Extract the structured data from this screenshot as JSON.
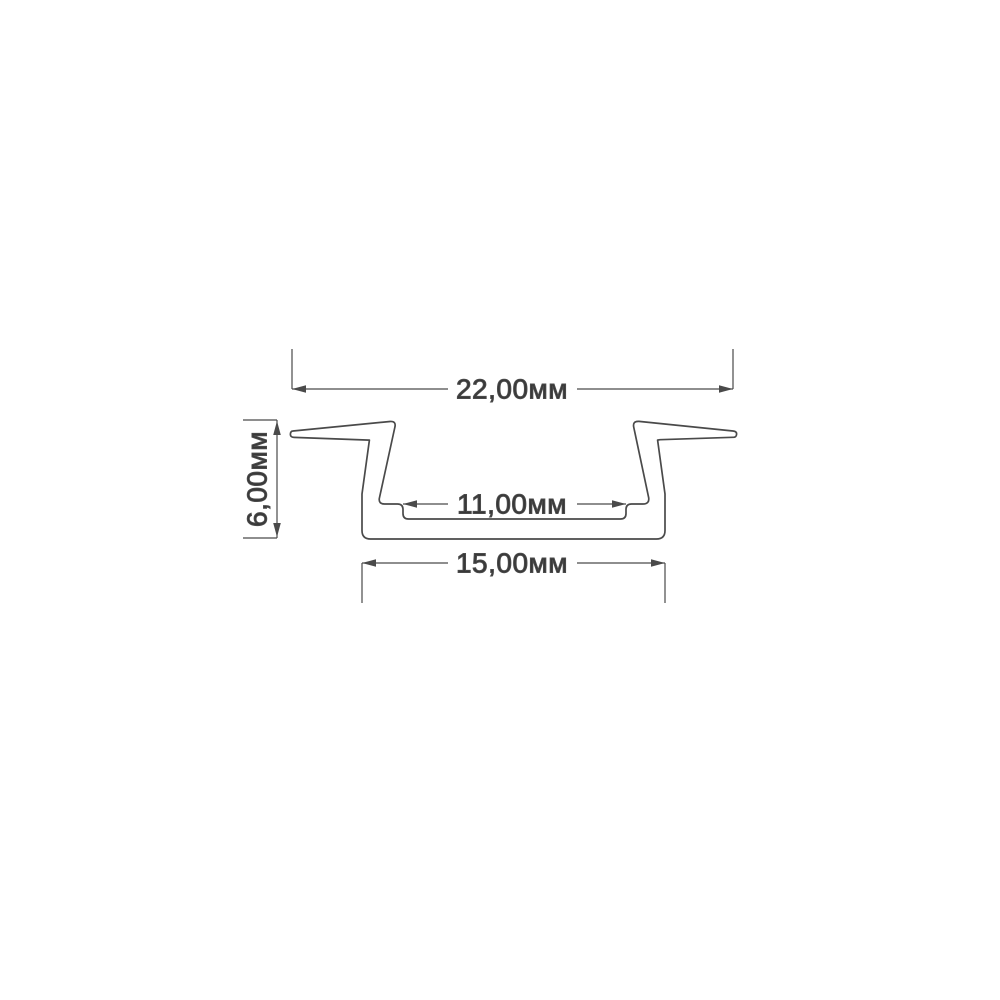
{
  "drawing": {
    "type": "technical-cross-section",
    "subject": "recessed aluminium LED profile cross-section",
    "units": "мм",
    "colors": {
      "line": "#4a4a4a",
      "text": "#383838",
      "background": "#ffffff"
    },
    "dimensions": {
      "overall_width": {
        "value": "22,00",
        "unit": "мм",
        "label": "22,00мм"
      },
      "height": {
        "value": "6,00",
        "unit": "мм",
        "label": "6,00мм"
      },
      "inner_width": {
        "value": "11,00",
        "unit": "мм",
        "label": "11,00мм"
      },
      "base_width": {
        "value": "15,00",
        "unit": "мм",
        "label": "15,00мм"
      }
    }
  }
}
